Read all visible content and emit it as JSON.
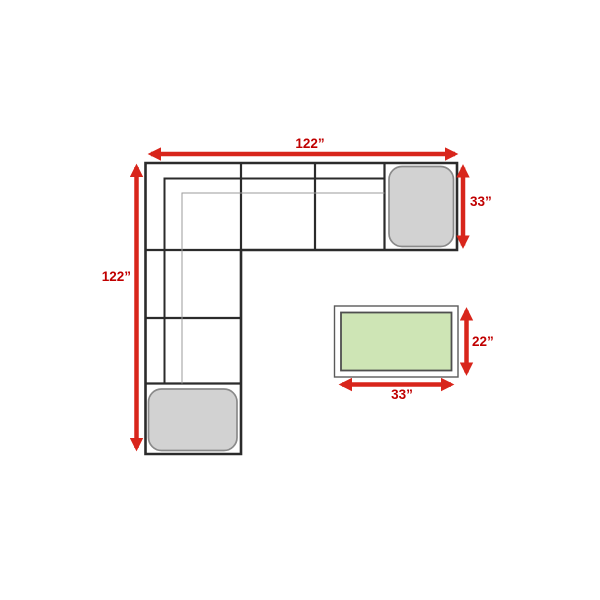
{
  "diagram": {
    "kind": "sectional-sofa-dimension-diagram",
    "sofa": {
      "width_label": "122”",
      "height_label": "122”",
      "depth_label": "33”"
    },
    "coffee_table": {
      "width_label": "33”",
      "depth_label": "22”"
    },
    "colors": {
      "arrow_red": "#D8251B",
      "label_red": "#C00000",
      "sofa_outline": "#2B2B2B",
      "seat_seam_gray": "#9B9B9B",
      "ottoman_fill": "#D2D2D2",
      "ottoman_stroke": "#8A8A8A",
      "table_top_green": "#CEE5B5",
      "table_stroke": "#4F4F4F",
      "background": "#FFFFFF"
    }
  }
}
